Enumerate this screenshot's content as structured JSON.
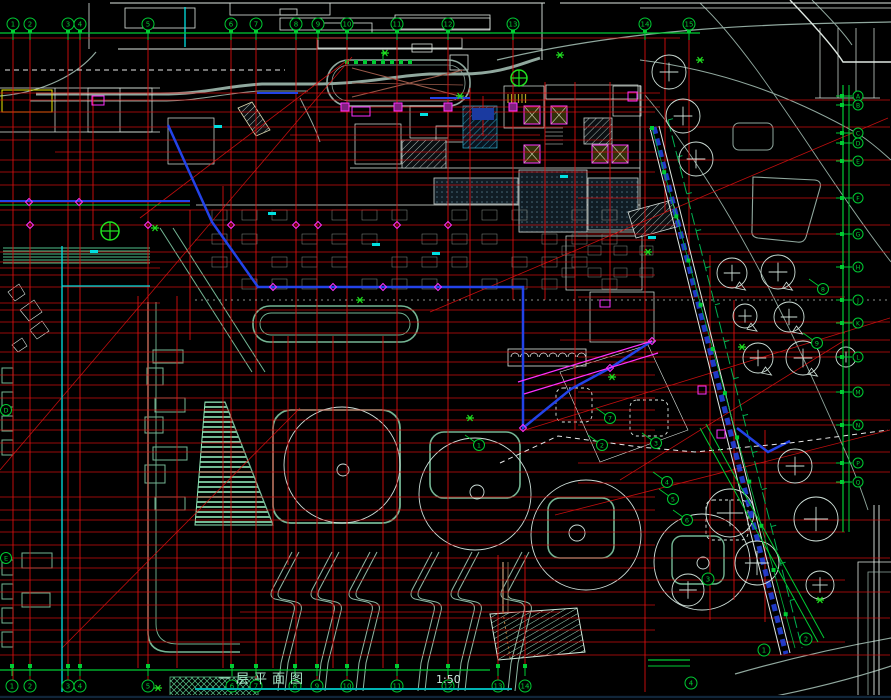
{
  "drawing": {
    "title": "一层平面图",
    "scale": "1:50"
  },
  "axes": {
    "top": [
      "1",
      "2",
      "3",
      "4",
      "5",
      "6",
      "7",
      "8",
      "9",
      "10",
      "11",
      "12",
      "13",
      "14",
      "15"
    ],
    "bottom": [
      "1",
      "2",
      "3",
      "4",
      "5",
      "6",
      "7",
      "8",
      "9",
      "10",
      "11",
      "12",
      "13",
      "14"
    ],
    "right": [
      "A",
      "B",
      "C",
      "D",
      "E",
      "F",
      "G",
      "H",
      "J",
      "K",
      "L",
      "M",
      "N",
      "P",
      "Q"
    ],
    "diagonal": [
      "1",
      "2",
      "3",
      "4"
    ],
    "plan_markers": [
      "1",
      "2",
      "3",
      "4",
      "5",
      "6",
      "7",
      "8",
      "9"
    ],
    "left": [
      "D",
      "E"
    ]
  },
  "colors": {
    "background": "#000000",
    "grid_red": "#e01010",
    "axis_green": "#00cc33",
    "bright_green": "#20e020",
    "landscape_teal": "#74b694",
    "stripe_green": "#8fe8b8",
    "envelope_blue": "#2343e8",
    "accent_magenta": "#ff30ff",
    "accent_cyan": "#00e0e0",
    "accent_yellow": "#e8e800",
    "line_white": "#dfe8e2",
    "road_gray": "#90a89e",
    "ramp_maroon": "#9a5a4a",
    "title_text": "#abe8cc",
    "underline_cyan": "#00b4b4"
  }
}
